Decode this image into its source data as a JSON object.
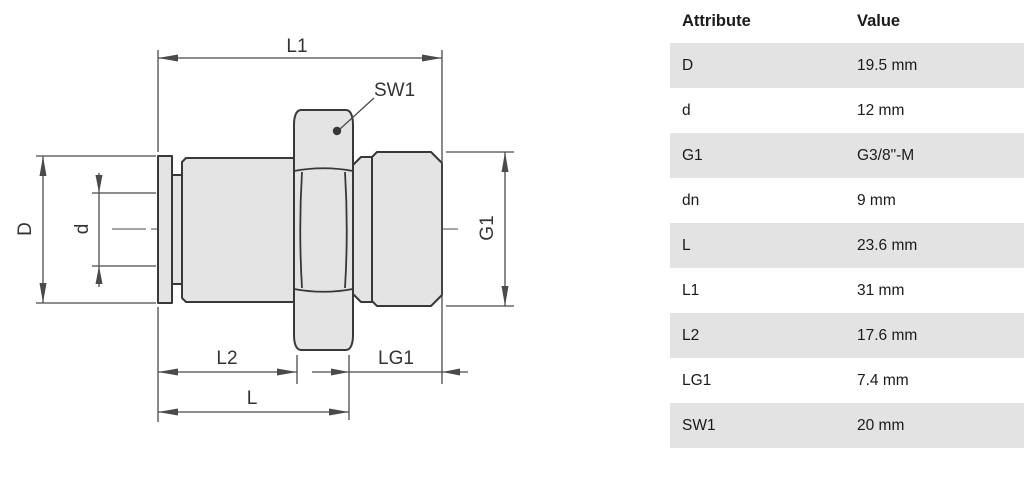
{
  "drawing": {
    "labels": {
      "l1": "L1",
      "sw1": "SW1",
      "d_outer": "D",
      "d_inner": "d",
      "g1": "G1",
      "l2": "L2",
      "lg1": "LG1",
      "l": "L"
    },
    "part_fill_color": "#e4e4e4",
    "outline_color": "#383838",
    "dimension_line_color": "#4a4a4a"
  },
  "table": {
    "headers": {
      "attribute": "Attribute",
      "value": "Value"
    },
    "stripe_color": "#e3e3e3",
    "rows": [
      {
        "attribute": "D",
        "value": "19.5 mm"
      },
      {
        "attribute": "d",
        "value": "12 mm"
      },
      {
        "attribute": "G1",
        "value": "G3/8\"-M"
      },
      {
        "attribute": "dn",
        "value": "9 mm"
      },
      {
        "attribute": "L",
        "value": "23.6 mm"
      },
      {
        "attribute": "L1",
        "value": "31 mm"
      },
      {
        "attribute": "L2",
        "value": "17.6 mm"
      },
      {
        "attribute": "LG1",
        "value": "7.4 mm"
      },
      {
        "attribute": "SW1",
        "value": "20 mm"
      }
    ]
  }
}
